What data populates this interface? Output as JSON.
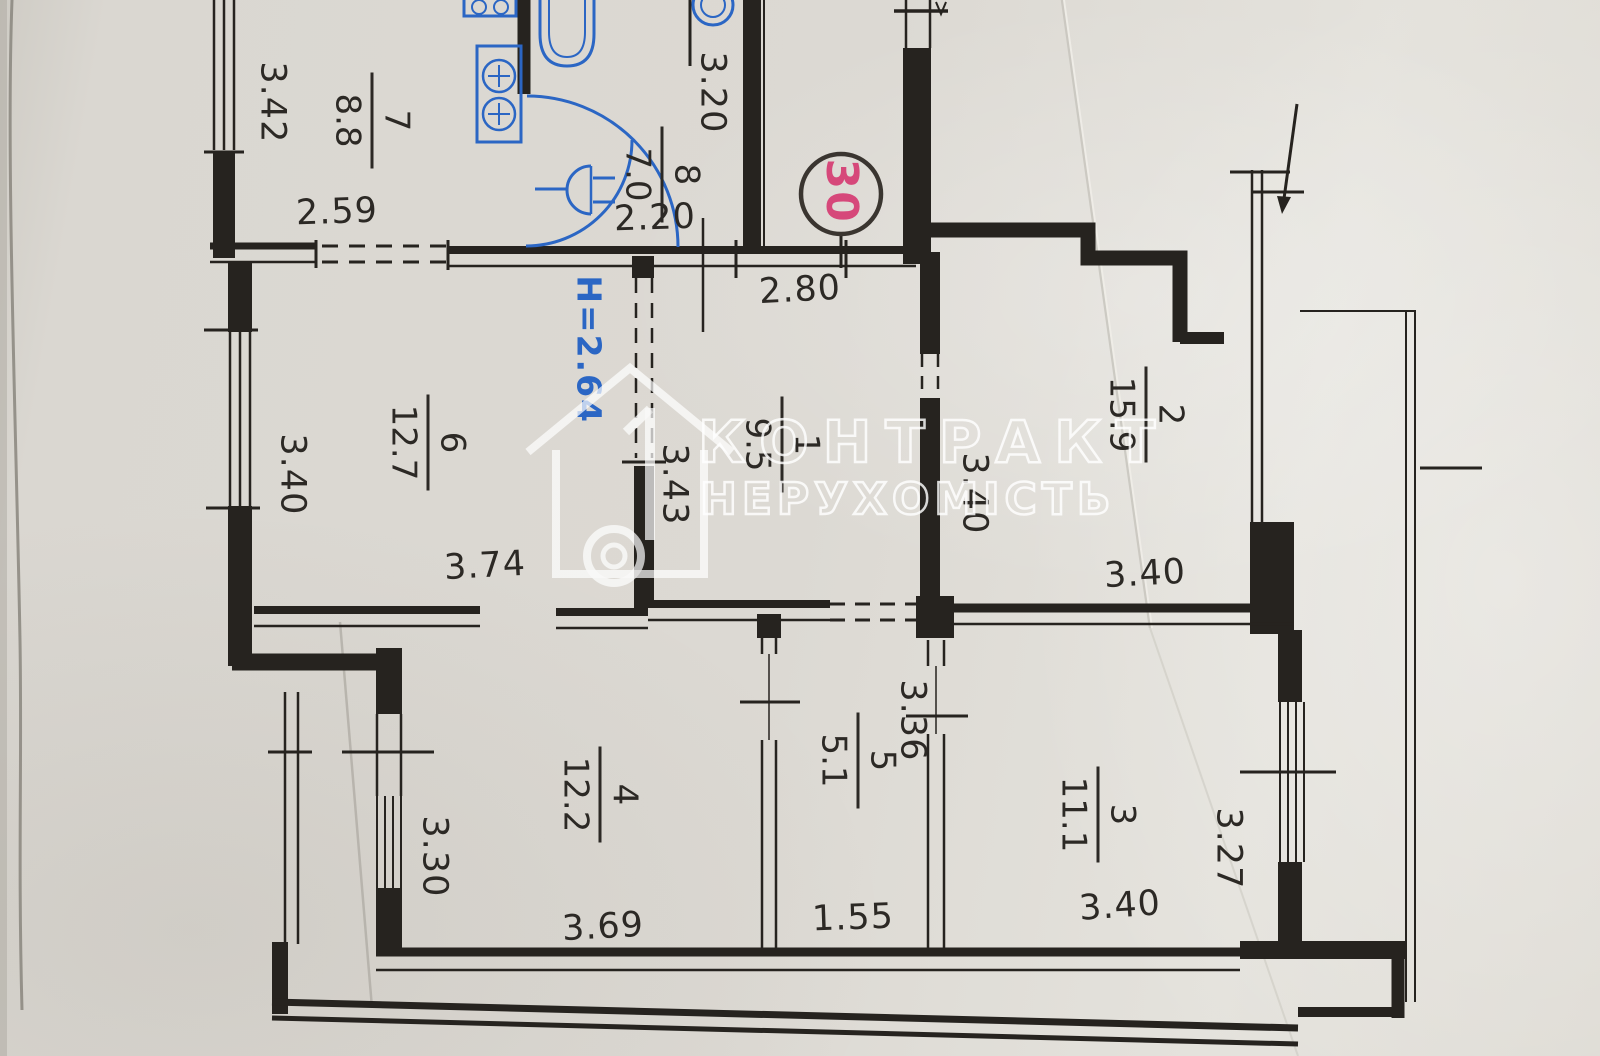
{
  "plan": {
    "apartment_number": "30",
    "height_note": "H=2.64",
    "watermark": {
      "line1": "КОНТРАКТ",
      "line2": "НЕРУХОМІСТЬ"
    },
    "rooms": [
      {
        "number": "1",
        "area": "9.5"
      },
      {
        "number": "2",
        "area": "15.9"
      },
      {
        "number": "3",
        "area": "11.1"
      },
      {
        "number": "4",
        "area": "12.2"
      },
      {
        "number": "5",
        "area": "5.1"
      },
      {
        "number": "6",
        "area": "12.7"
      },
      {
        "number": "7",
        "area": "8.8"
      },
      {
        "number": "8",
        "area": "7.0"
      }
    ],
    "dims": {
      "d342": "3.42",
      "d259": "2.59",
      "d220": "2.20",
      "d320": "3.20",
      "d280": "2.80",
      "d340_room6": "3.40",
      "d374": "3.74",
      "d343": "3.43",
      "d340_hall": "3.40",
      "d340_room2": "3.40",
      "d330": "3.30",
      "d369": "3.69",
      "d336": "3.36",
      "d155": "1.55",
      "d340_room3": "3.40",
      "d327": "3.27"
    }
  }
}
